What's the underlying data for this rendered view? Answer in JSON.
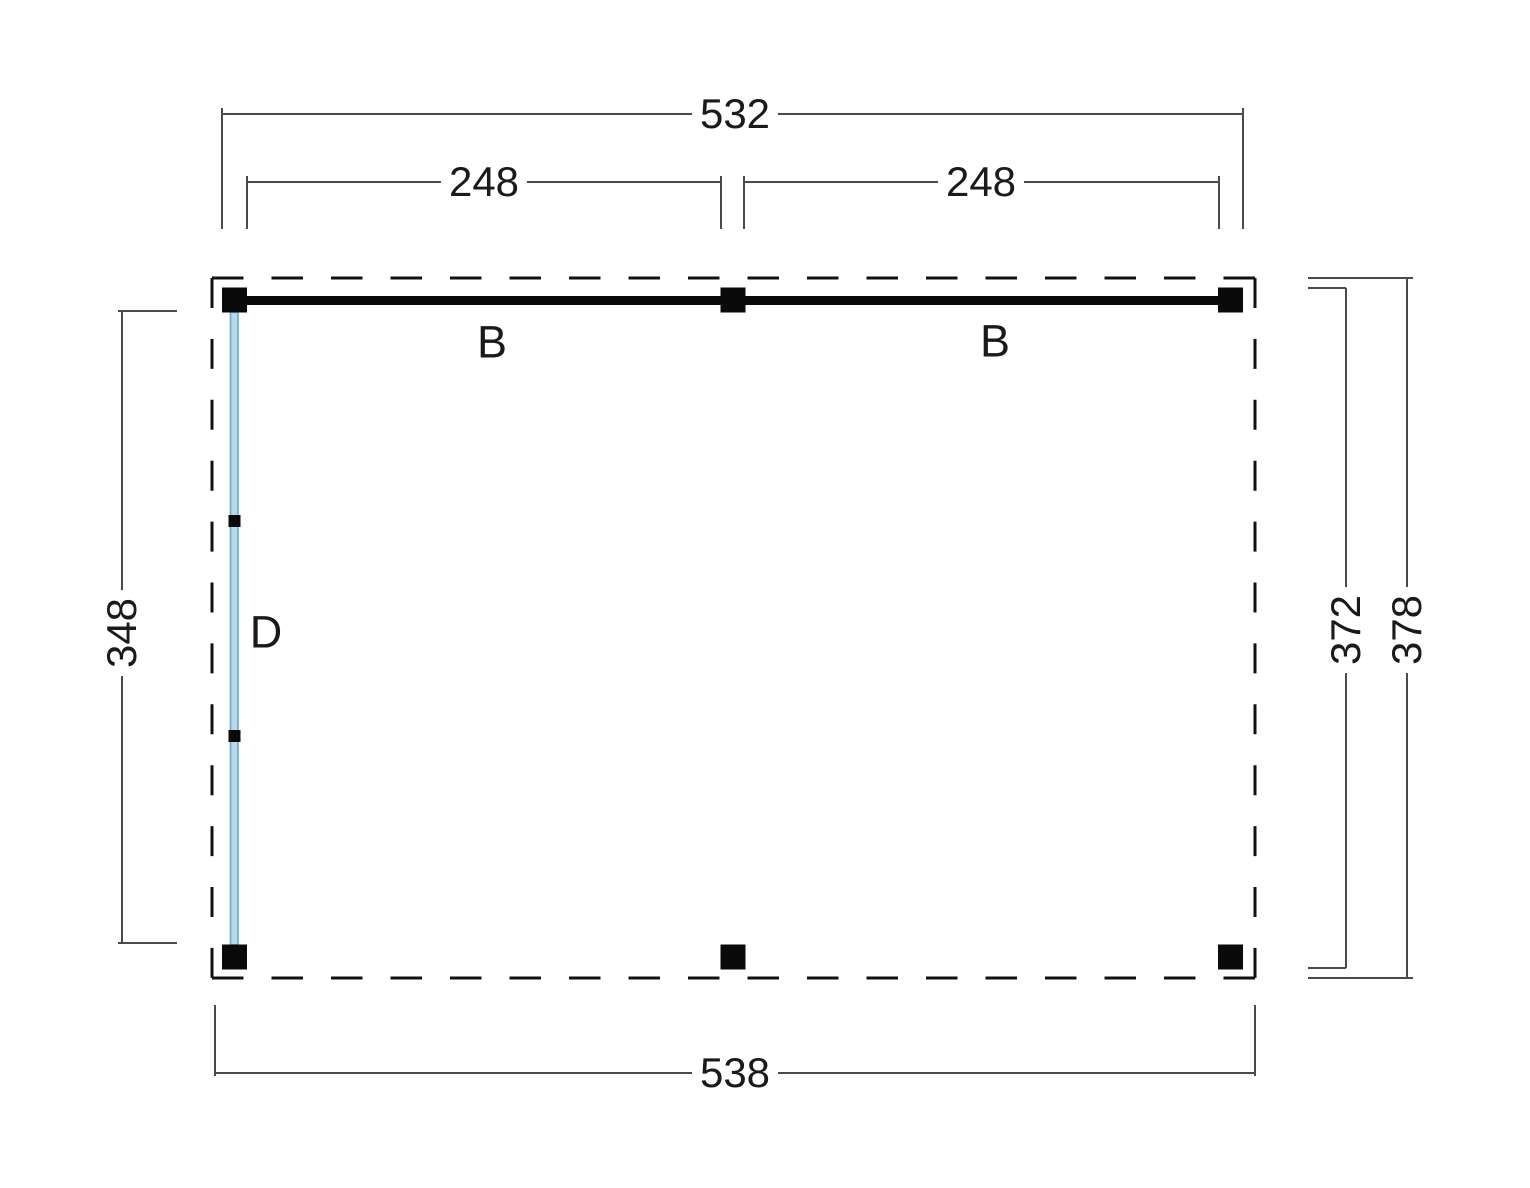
{
  "plan": {
    "dimensions": {
      "overall_width_top": "532",
      "bay_left": "248",
      "bay_right": "248",
      "side_height_left": "348",
      "side_height_inner_right": "372",
      "side_height_outer_right": "378",
      "overall_width_bottom": "538"
    },
    "parts": {
      "beam_left": "B",
      "beam_right": "B",
      "wall": "D"
    },
    "colors": {
      "outline": "#111111",
      "beam": "#0a0a0a",
      "post": "#0a0a0a",
      "dimension_line": "#4a4a4a",
      "text": "#1a1a1a",
      "wall_fill": "#b5d9eb",
      "wall_stroke": "#69a9cd",
      "background": "#ffffff"
    }
  }
}
